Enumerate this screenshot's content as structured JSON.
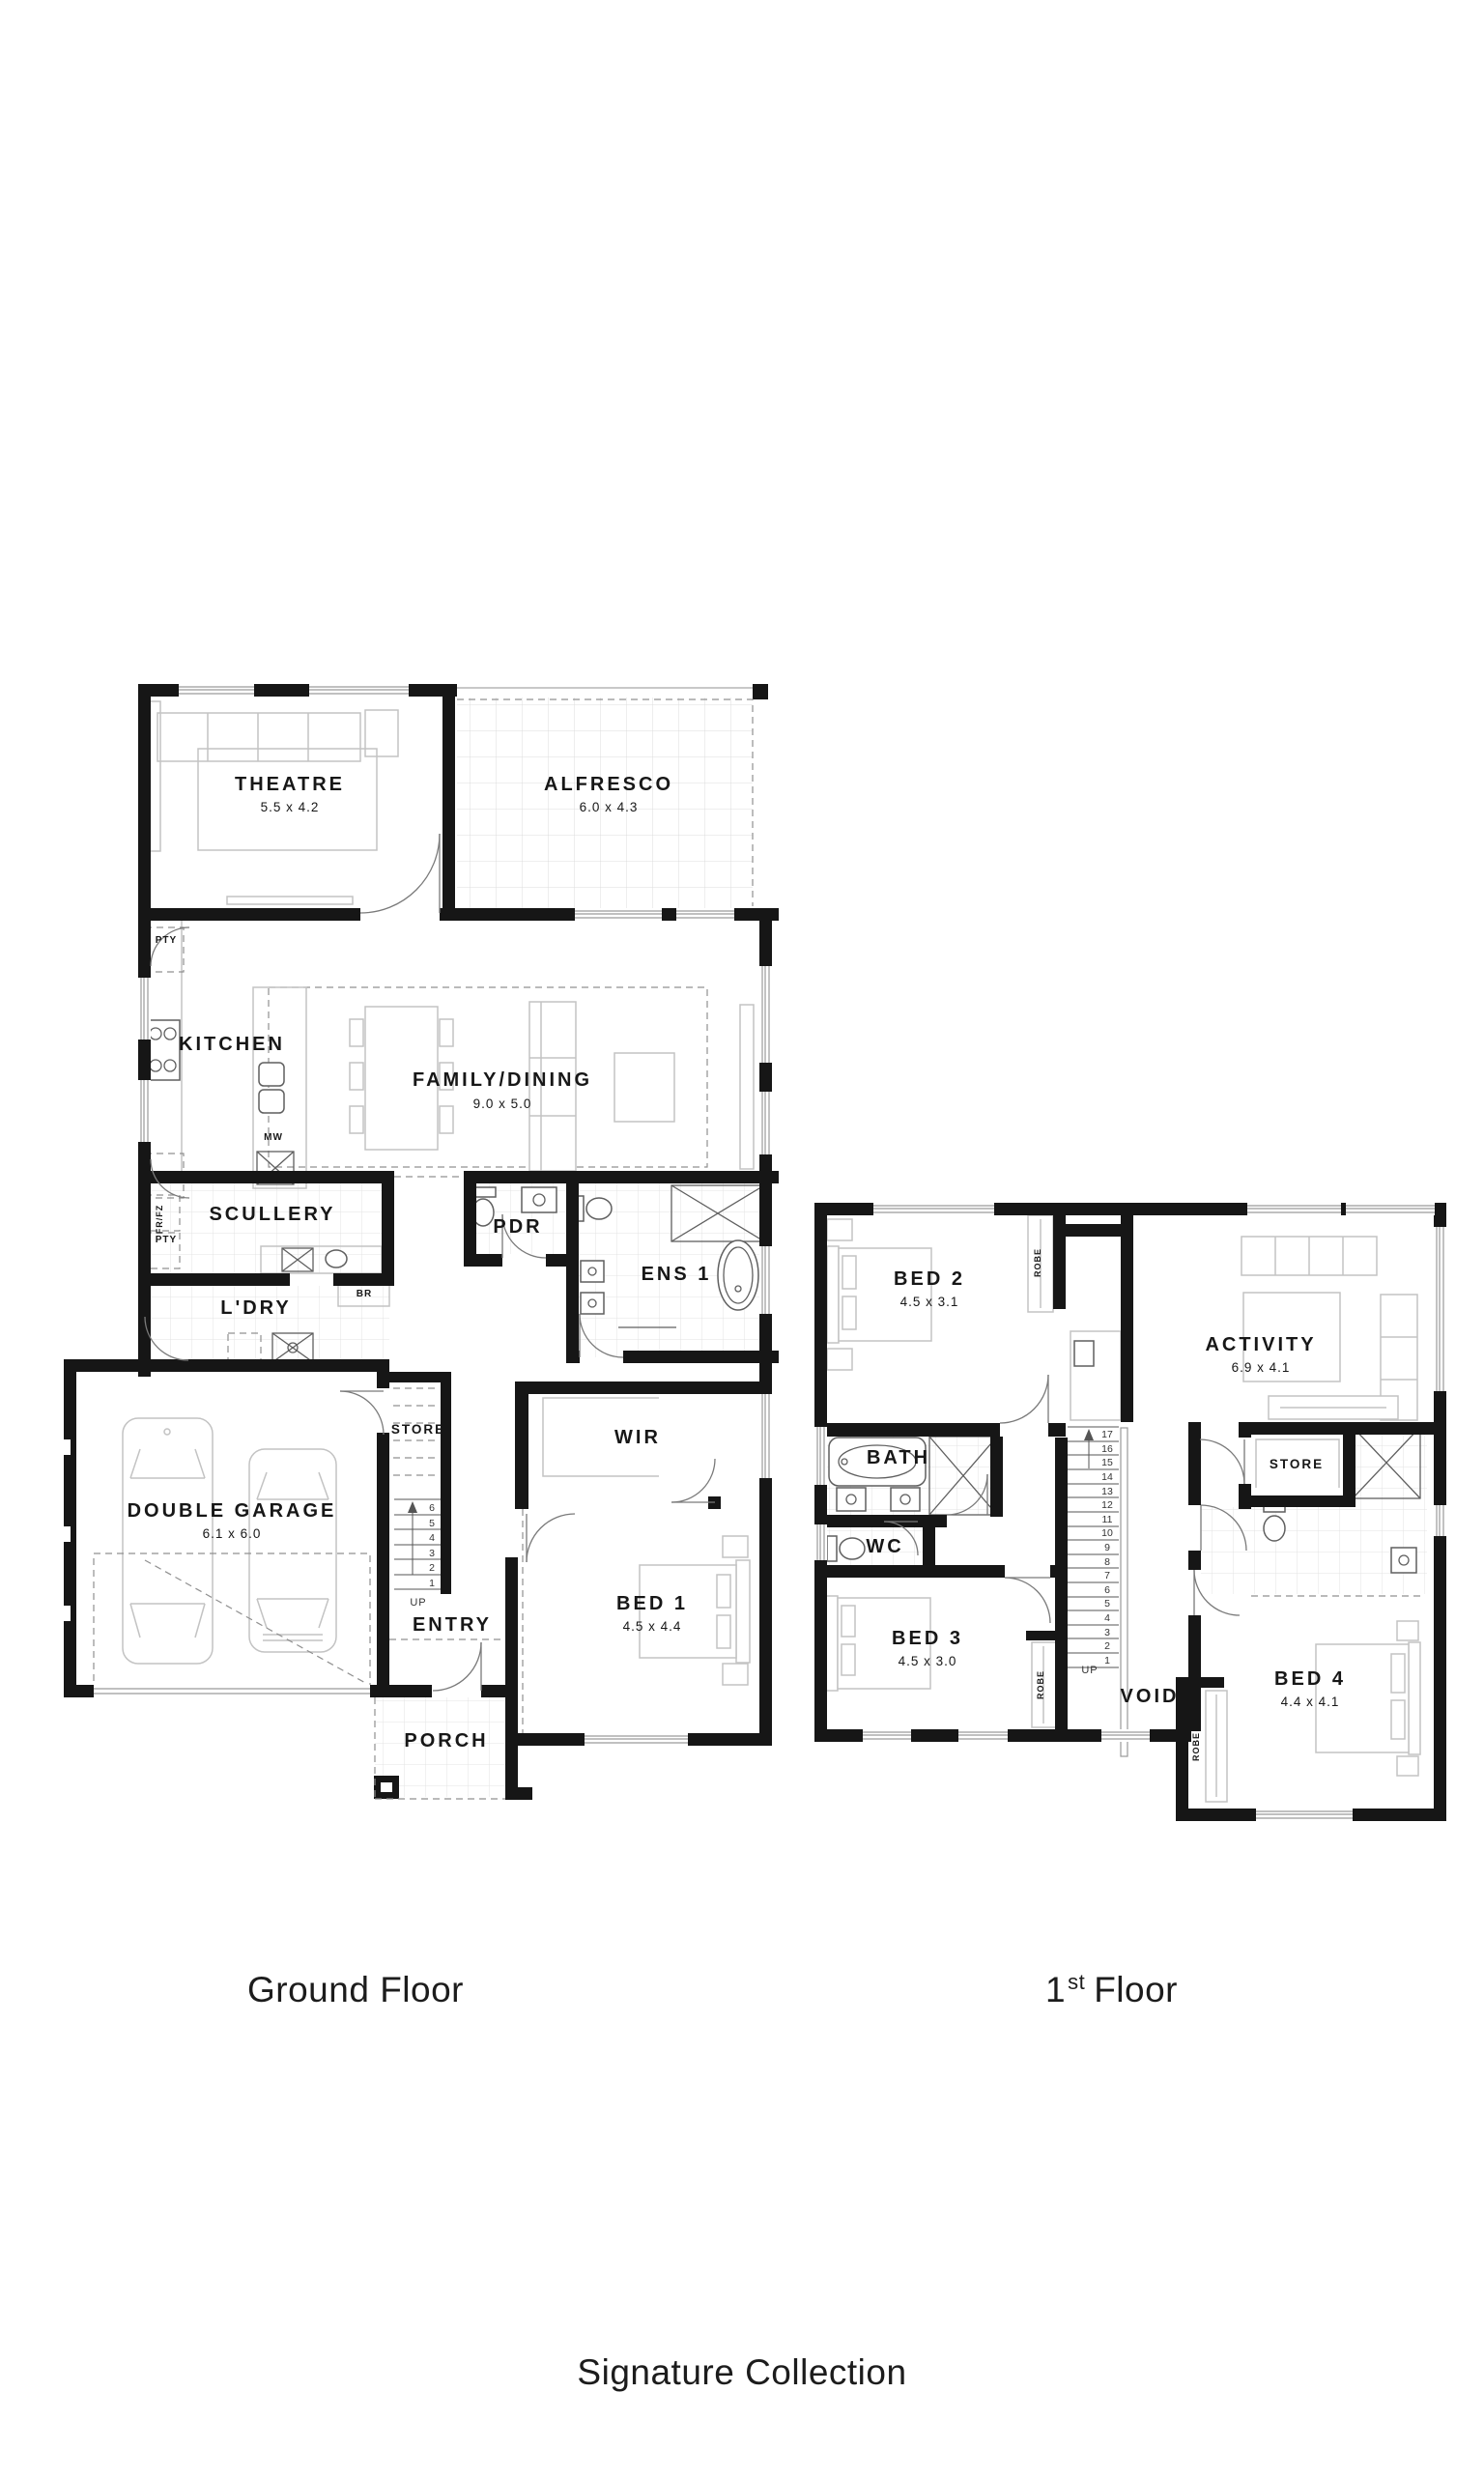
{
  "titles": {
    "ground": "Ground Floor",
    "first_num": "1",
    "first_ord": "st",
    "first_rest": "Floor",
    "collection": "Signature Collection"
  },
  "ground_floor": {
    "rooms": {
      "theatre": {
        "label": "THEATRE",
        "dims": "5.5 x 4.2"
      },
      "alfresco": {
        "label": "ALFRESCO",
        "dims": "6.0 x 4.3"
      },
      "kitchen": {
        "label": "KITCHEN"
      },
      "family_dining": {
        "label": "FAMILY/DINING",
        "dims": "9.0 x 5.0"
      },
      "scullery": {
        "label": "SCULLERY"
      },
      "pdr": {
        "label": "PDR"
      },
      "ens1": {
        "label": "ENS 1"
      },
      "ldry": {
        "label": "L'DRY"
      },
      "store": {
        "label": "STORE"
      },
      "garage": {
        "label": "DOUBLE GARAGE",
        "dims": "6.1 x 6.0"
      },
      "entry": {
        "label": "ENTRY"
      },
      "wir": {
        "label": "WIR"
      },
      "bed1": {
        "label": "BED 1",
        "dims": "4.5 x 4.4"
      },
      "porch": {
        "label": "PORCH"
      }
    },
    "annotations": {
      "pty_top": "PTY",
      "pty_bottom": "PTY",
      "fridge": "FR/FZ",
      "broom": "BR",
      "microwave": "MW",
      "up": "UP"
    },
    "stairs": [
      "6",
      "5",
      "4",
      "3",
      "2",
      "1"
    ]
  },
  "first_floor": {
    "rooms": {
      "bed2": {
        "label": "BED 2",
        "dims": "4.5 x 3.1"
      },
      "activity": {
        "label": "ACTIVITY",
        "dims": "6.9 x 4.1"
      },
      "bath": {
        "label": "BATH"
      },
      "store": {
        "label": "STORE"
      },
      "wc": {
        "label": "WC"
      },
      "bed3": {
        "label": "BED 3",
        "dims": "4.5 x 3.0"
      },
      "void": {
        "label": "VOID"
      },
      "bed4": {
        "label": "BED 4",
        "dims": "4.4 x 4.1"
      }
    },
    "annotations": {
      "robe_bed2": "ROBE",
      "robe_bed3": "ROBE",
      "robe_bed4": "ROBE",
      "up": "UP"
    },
    "stairs": [
      "17",
      "16",
      "15",
      "14",
      "13",
      "12",
      "11",
      "10",
      "9",
      "8",
      "7",
      "6",
      "5",
      "4",
      "3",
      "2",
      "1"
    ]
  },
  "colors": {
    "wall": "#161616",
    "furniture": "#c3c3c3",
    "fixture": "#5f5f5f",
    "tile": "#e3e3e3",
    "text": "#171717"
  }
}
